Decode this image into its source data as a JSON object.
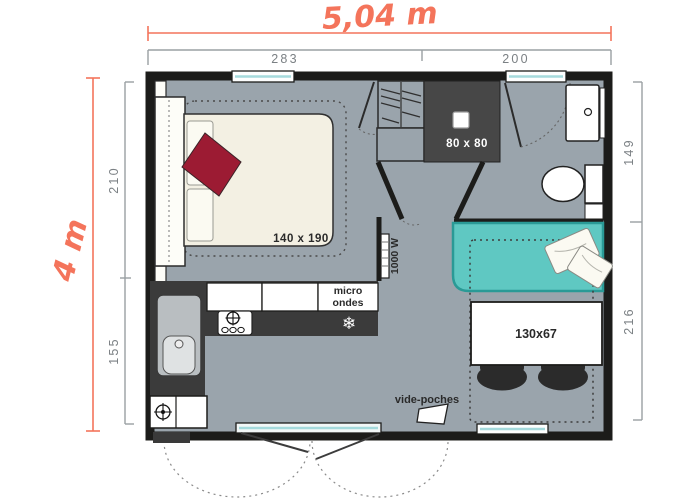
{
  "plan": {
    "overall_width_label": "5,04 m",
    "overall_height_label": "4 m",
    "top_segments": [
      "283",
      "200"
    ],
    "left_segments": [
      "210",
      "155"
    ],
    "right_segments": [
      "149",
      "216"
    ],
    "labels": {
      "bed": "140 x 190",
      "shower": "80 x 80",
      "microwave_line1": "micro",
      "microwave_line2": "ondes",
      "heater": "1000 W",
      "table": "130x67",
      "vide_poches": "vide-poches"
    },
    "icons": {
      "freezer_glyph": "❄"
    },
    "colors": {
      "accent": "#f4745b",
      "wall": "#1c1c1a",
      "floor": "#9aa4ac",
      "counter": "#3b3b3b",
      "shower": "#474747",
      "sofa": "#5fc8c2",
      "sofa_border": "#2a9a96",
      "bed": "#f3f0e3",
      "blanket": "#9c1b33",
      "window": "#a5dadc"
    }
  }
}
